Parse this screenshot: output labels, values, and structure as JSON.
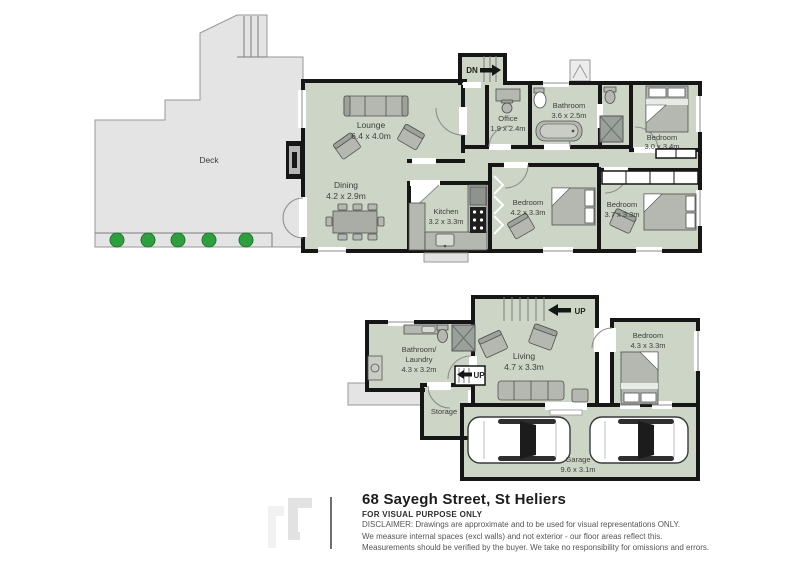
{
  "document": {
    "type": "floor-plan",
    "address": "68 Sayegh Street, St Heliers",
    "purpose_note": "FOR VISUAL PURPOSE ONLY",
    "disclaimer": {
      "line1": "DISCLAIMER:  Drawings are approximate and to be used for visual representations ONLY.",
      "line2": "We measure internal spaces (excl walls) and not exterior - our floor areas reflect this.",
      "line3": "Measurements should be verified by the buyer. We take no responsibility for omissions and errors."
    }
  },
  "upper_floor": {
    "deck": {
      "name": "Deck"
    },
    "lounge": {
      "name": "Lounge",
      "dims": "6.4 x 4.0m"
    },
    "dining": {
      "name": "Dining",
      "dims": "4.2 x 2.9m"
    },
    "kitchen": {
      "name": "Kitchen",
      "dims": "3.2 x 3.3m"
    },
    "office": {
      "name": "Office",
      "dims": "1.9 x 2.4m"
    },
    "bathroom": {
      "name": "Bathroom",
      "dims": "3.6 x 2.5m"
    },
    "bedroom_top": {
      "name": "Bedroom",
      "dims": "3.0 x 3.4m"
    },
    "bedroom_mid": {
      "name": "Bedroom",
      "dims": "4.2 x 3.3m"
    },
    "bedroom_right": {
      "name": "Bedroom",
      "dims": "3.7 x 3.3m"
    },
    "stairs_down_label": "DN"
  },
  "lower_floor": {
    "bathroom_laundry": {
      "name_line1": "Bathroom/",
      "name_line2": "Laundry",
      "dims": "4.3 x 3.2m"
    },
    "living": {
      "name": "Living",
      "dims": "4.7 x 3.3m"
    },
    "storage": {
      "name": "Storage"
    },
    "bedroom": {
      "name": "Bedroom",
      "dims": "4.3 x 3.3m"
    },
    "garage": {
      "name": "Garage",
      "dims": "9.6 x 3.1m"
    },
    "stairs_up_label_top": "UP",
    "stairs_up_label_mid": "UP"
  },
  "colors": {
    "floor_fill": "#cdd5c6",
    "wall": "#161616",
    "deck_fill": "#e4e4e4",
    "furniture": "#b4b8b0",
    "plants": "#2f9e41",
    "label_text": "#3d3d3d"
  }
}
